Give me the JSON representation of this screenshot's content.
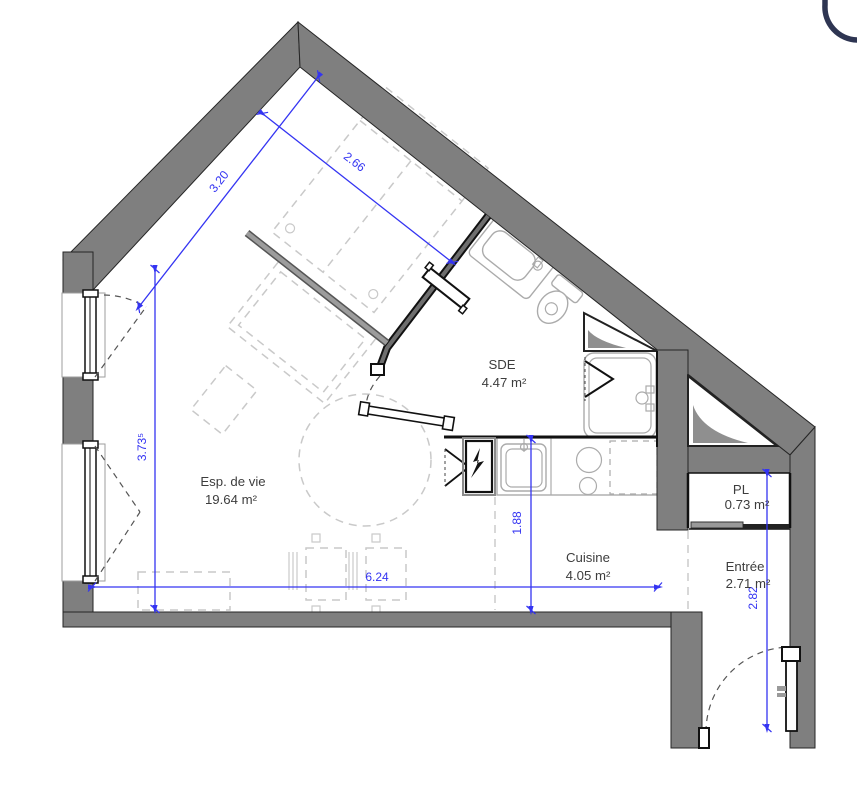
{
  "document": {
    "type": "architectural floor plan"
  },
  "logo": {
    "shape": "partial-circle",
    "color": "#2e3552"
  },
  "plan": {
    "rooms": [
      {
        "name": "Esp. de vie",
        "area": "19.64 m²"
      },
      {
        "name": "SDE",
        "area": "4.47 m²"
      },
      {
        "name": "Cuisine",
        "area": "4.05 m²"
      },
      {
        "name": "PL",
        "area": "0.73 m²"
      },
      {
        "name": "Entrée",
        "area": "2.71 m²"
      }
    ],
    "dimensions_m": {
      "left_slope": "3.20",
      "upper_slope": "2.66",
      "left_wall": "3.73⁵",
      "kitchen_depth": "1.88",
      "bottom_width": "6.24",
      "entry_depth": "2.82"
    },
    "colors": {
      "wall_gray": "#7f7f7f",
      "dimension_blue": "#3434f2",
      "fixture_gray": "#ababab",
      "furniture_gray": "#c9c9c9",
      "label_gray": "#3d3d3d",
      "logo_navy": "#2e3552"
    }
  }
}
